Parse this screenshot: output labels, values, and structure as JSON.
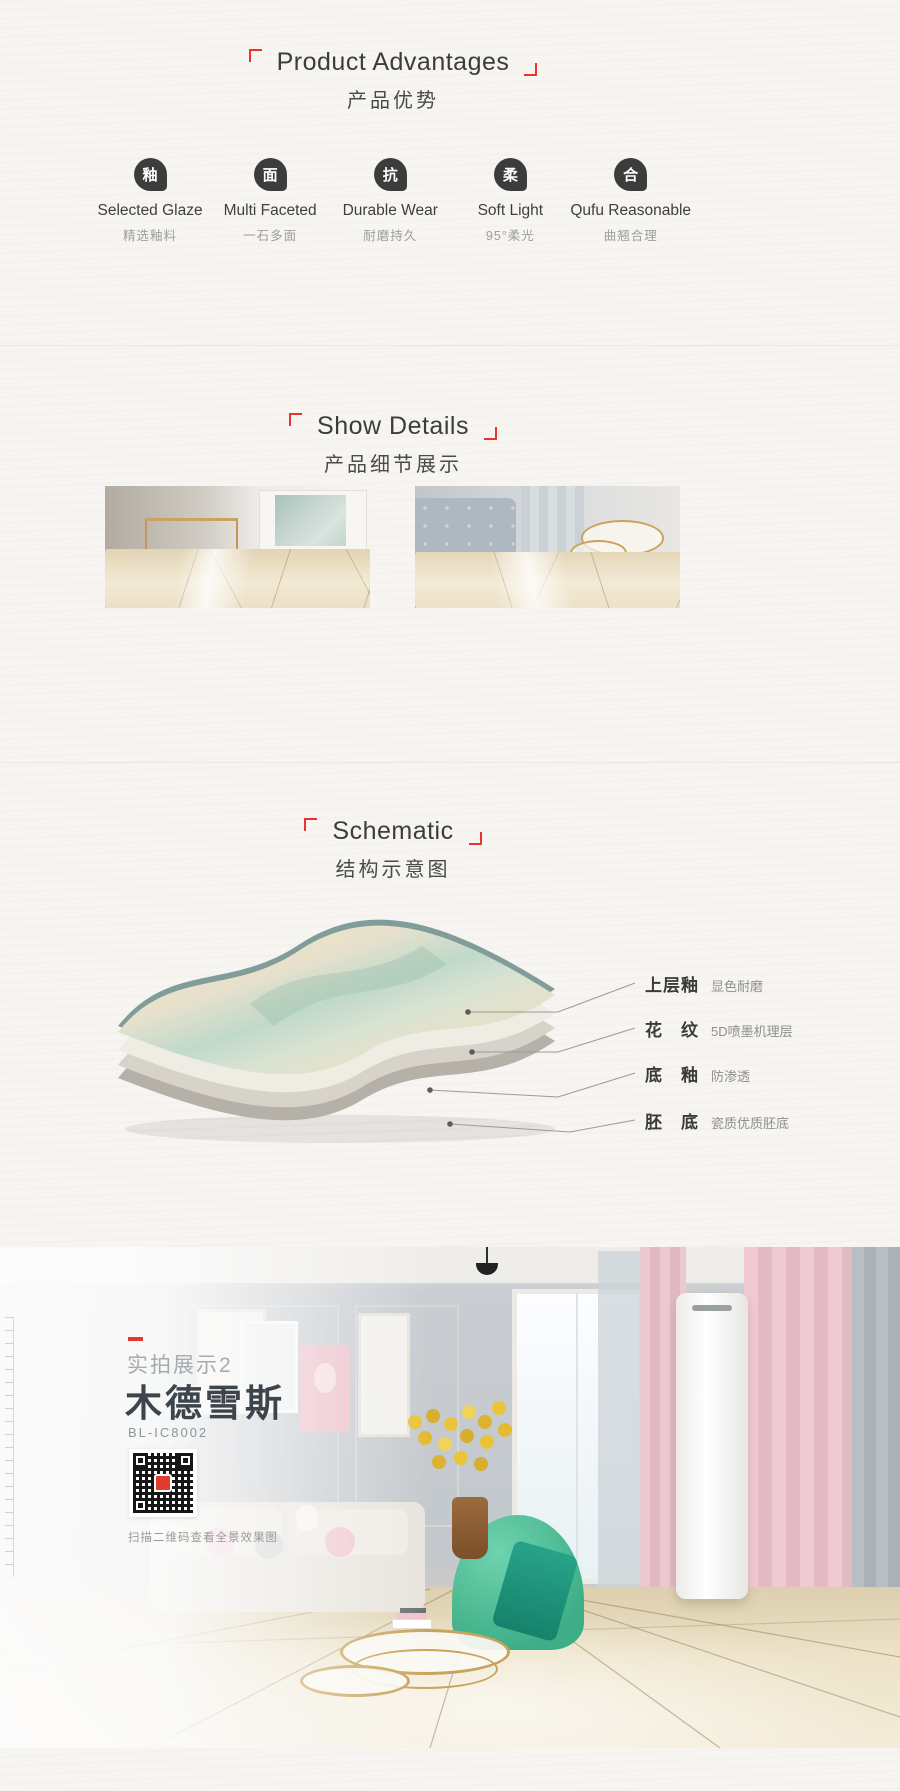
{
  "page": {
    "background": "#f7f5f2",
    "accent_red": "#e7342c",
    "text_dark": "#3c3c3c",
    "text_gray": "#9e9e9e"
  },
  "advantages": {
    "title_en": "Product Advantages",
    "title_zh": "产品优势",
    "items": [
      {
        "icon": "glaze-droplet-icon",
        "icon_char": "釉",
        "en": "Selected Glaze",
        "zh": "精选釉料"
      },
      {
        "icon": "surface-droplet-icon",
        "icon_char": "面",
        "en": "Multi Faceted",
        "zh": "一石多面"
      },
      {
        "icon": "wear-droplet-icon",
        "icon_char": "抗",
        "en": "Durable Wear",
        "zh": "耐磨持久"
      },
      {
        "icon": "soft-droplet-icon",
        "icon_char": "柔",
        "en": "Soft Light",
        "zh": "95°柔光"
      },
      {
        "icon": "fit-droplet-icon",
        "icon_char": "合",
        "en": "Qufu Reasonable",
        "zh": "曲翘合理"
      }
    ]
  },
  "details": {
    "title_en": "Show Details",
    "title_zh": "产品细节展示",
    "photos": [
      "marble-tile-floor-with-console-table",
      "marble-tile-floor-with-sofa-and-gold-tables"
    ]
  },
  "schematic": {
    "title_en": "Schematic",
    "title_zh": "结构示意图",
    "layers": [
      {
        "name": "上层釉",
        "desc": "显色耐磨"
      },
      {
        "name": "花　纹",
        "desc": "5D喷墨机理层"
      },
      {
        "name": "底　釉",
        "desc": "防渗透"
      },
      {
        "name": "胚　底",
        "desc": "瓷质优质胚底"
      }
    ],
    "tile_colors": {
      "marble": "#e9dcc0",
      "sheen": "#bcd8cb",
      "rim": "#819d9a"
    }
  },
  "showcase": {
    "tag": "实拍展示2",
    "product_name": "木德雪斯",
    "model": "BL-IC8002",
    "qr_caption": "扫描二维码查看全景效果图",
    "scene_colors": {
      "wall": "#c6cacd",
      "curtain_pink": "#edc6ce",
      "chair_green": "#4fc19b",
      "floor_beige": "#ecdfc2",
      "gold": "#c8a35a"
    }
  }
}
